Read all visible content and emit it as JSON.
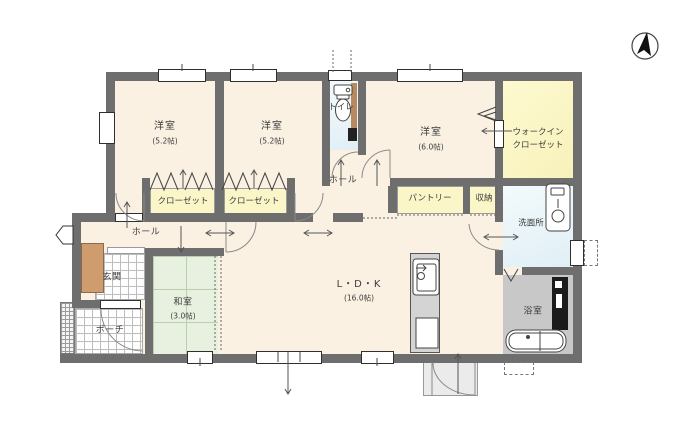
{
  "rooms": {
    "bedroom1": {
      "label": "洋室",
      "size": "(5.2帖)"
    },
    "bedroom2": {
      "label": "洋室",
      "size": "(5.2帖)"
    },
    "bedroom3": {
      "label": "洋室",
      "size": "(6.0帖)"
    },
    "walkin_closet": {
      "label": "ウォークイン",
      "label2": "クローゼット"
    },
    "toilet": {
      "label": "トイレ"
    },
    "hall_upper": {
      "label": "ホール"
    },
    "closet_left": {
      "label": "クローゼット"
    },
    "closet_right": {
      "label": "クローゼット"
    },
    "pantry": {
      "label": "パントリー"
    },
    "storage": {
      "label": "収納"
    },
    "washroom": {
      "label": "洗面所"
    },
    "hall_lower": {
      "label": "ホール"
    },
    "entrance": {
      "label": "玄関"
    },
    "japanese_room": {
      "label": "和室",
      "size": "(3.0帖)"
    },
    "ldk": {
      "label": "L・D・K",
      "size": "(16.0帖)"
    },
    "bathroom": {
      "label": "浴室"
    },
    "porch": {
      "label": "ポーチ"
    }
  },
  "icons": {
    "compass": "north-arrow-icon",
    "toilet": "toilet-icon",
    "washbasin": "washbasin-icon",
    "bathtub": "bathtub-icon",
    "kitchen_sink": "kitchen-sink-icon"
  },
  "colors": {
    "wall": "#6e6e6e",
    "floor": "#faf1e3",
    "closet": "#faf6c8",
    "water": "#e0eff6",
    "bath": "#c8c8c8",
    "tatami": "#e8f1e0",
    "tatami_line": "#b9cfae",
    "cabinet": "#cf9c6e",
    "door_brown": "#b9895e",
    "tile_line": "#bcbcbc"
  }
}
